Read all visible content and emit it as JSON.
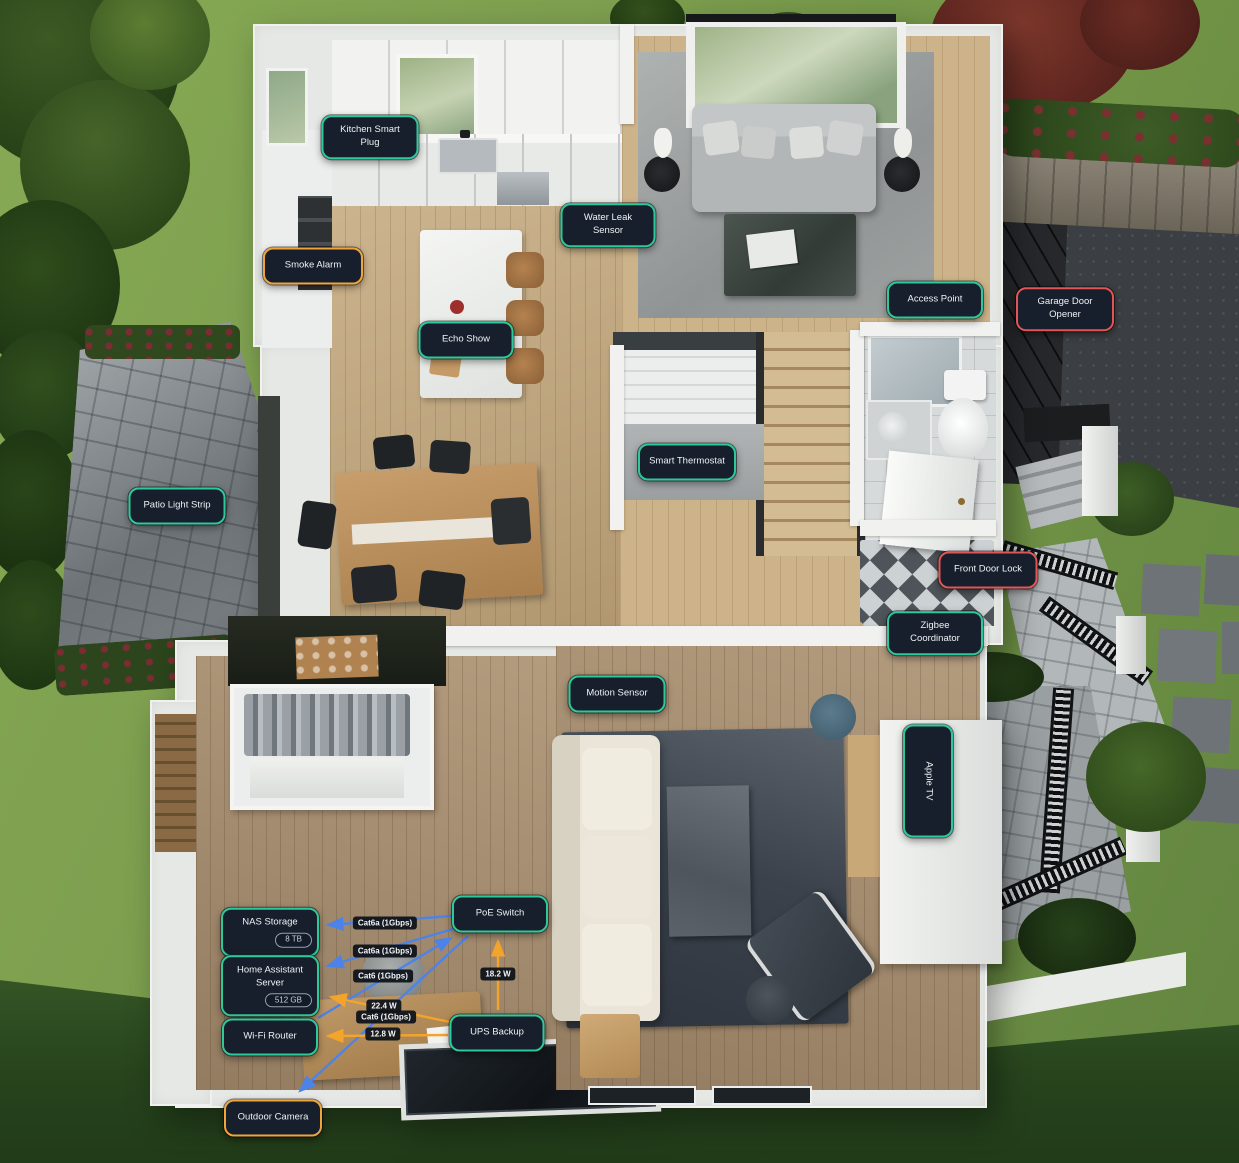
{
  "colors": {
    "label_bg": "#161f2b",
    "status_ok": "#2fc79c",
    "status_warning": "#f0a43c",
    "status_alert": "#e15556",
    "ethernet_line": "#4d83e9",
    "power_line": "#f5a42b"
  },
  "devices": [
    {
      "id": "kitchen-smart-plug",
      "label": "Kitchen Smart Plug",
      "status": "ok"
    },
    {
      "id": "water-leak-sensor",
      "label": "Water Leak Sensor",
      "status": "ok"
    },
    {
      "id": "smoke-alarm",
      "label": "Smoke Alarm",
      "status": "warning"
    },
    {
      "id": "access-point",
      "label": "Access Point",
      "status": "ok"
    },
    {
      "id": "garage-door-opener",
      "label": "Garage Door Opener",
      "status": "alert"
    },
    {
      "id": "echo-show",
      "label": "Echo Show",
      "status": "ok"
    },
    {
      "id": "smart-thermostat",
      "label": "Smart Thermostat",
      "status": "ok"
    },
    {
      "id": "patio-light-strip",
      "label": "Patio Light Strip",
      "status": "ok"
    },
    {
      "id": "front-door-lock",
      "label": "Front Door Lock",
      "status": "alert"
    },
    {
      "id": "zigbee-coordinator",
      "label": "Zigbee Coordinator",
      "status": "ok"
    },
    {
      "id": "motion-sensor",
      "label": "Motion Sensor",
      "status": "ok"
    },
    {
      "id": "apple-tv",
      "label": "Apple TV",
      "status": "ok"
    },
    {
      "id": "nas-storage",
      "label": "NAS Storage",
      "status": "ok",
      "badge": "8 TB"
    },
    {
      "id": "poe-switch",
      "label": "PoE Switch",
      "status": "ok"
    },
    {
      "id": "home-assistant-server",
      "label": "Home Assistant Server",
      "status": "ok",
      "badge": "512 GB"
    },
    {
      "id": "wifi-router",
      "label": "Wi-Fi Router",
      "status": "ok"
    },
    {
      "id": "ups-backup",
      "label": "UPS Backup",
      "status": "ok"
    },
    {
      "id": "outdoor-camera",
      "label": "Outdoor Camera",
      "status": "warning"
    }
  ],
  "connections": [
    {
      "from": "PoE Switch",
      "to": "NAS Storage",
      "label": "Cat6a (1Gbps)",
      "kind": "ethernet"
    },
    {
      "from": "PoE Switch",
      "to": "Home Assistant Server",
      "label": "Cat6a (1Gbps)",
      "kind": "ethernet"
    },
    {
      "from": "Wi-Fi Router",
      "to": "PoE Switch",
      "label": "Cat6 (1Gbps)",
      "kind": "ethernet"
    },
    {
      "from": "PoE Switch",
      "to": "Outdoor Camera",
      "label": "Cat6 (1Gbps)",
      "kind": "ethernet"
    },
    {
      "from": "UPS Backup",
      "to": "PoE Switch",
      "label": "18.2 W",
      "kind": "power"
    },
    {
      "from": "UPS Backup",
      "to": "Home Assistant Server",
      "label": "22.4 W",
      "kind": "power"
    },
    {
      "from": "UPS Backup",
      "to": "Wi-Fi Router",
      "label": "12.8 W",
      "kind": "power"
    }
  ]
}
